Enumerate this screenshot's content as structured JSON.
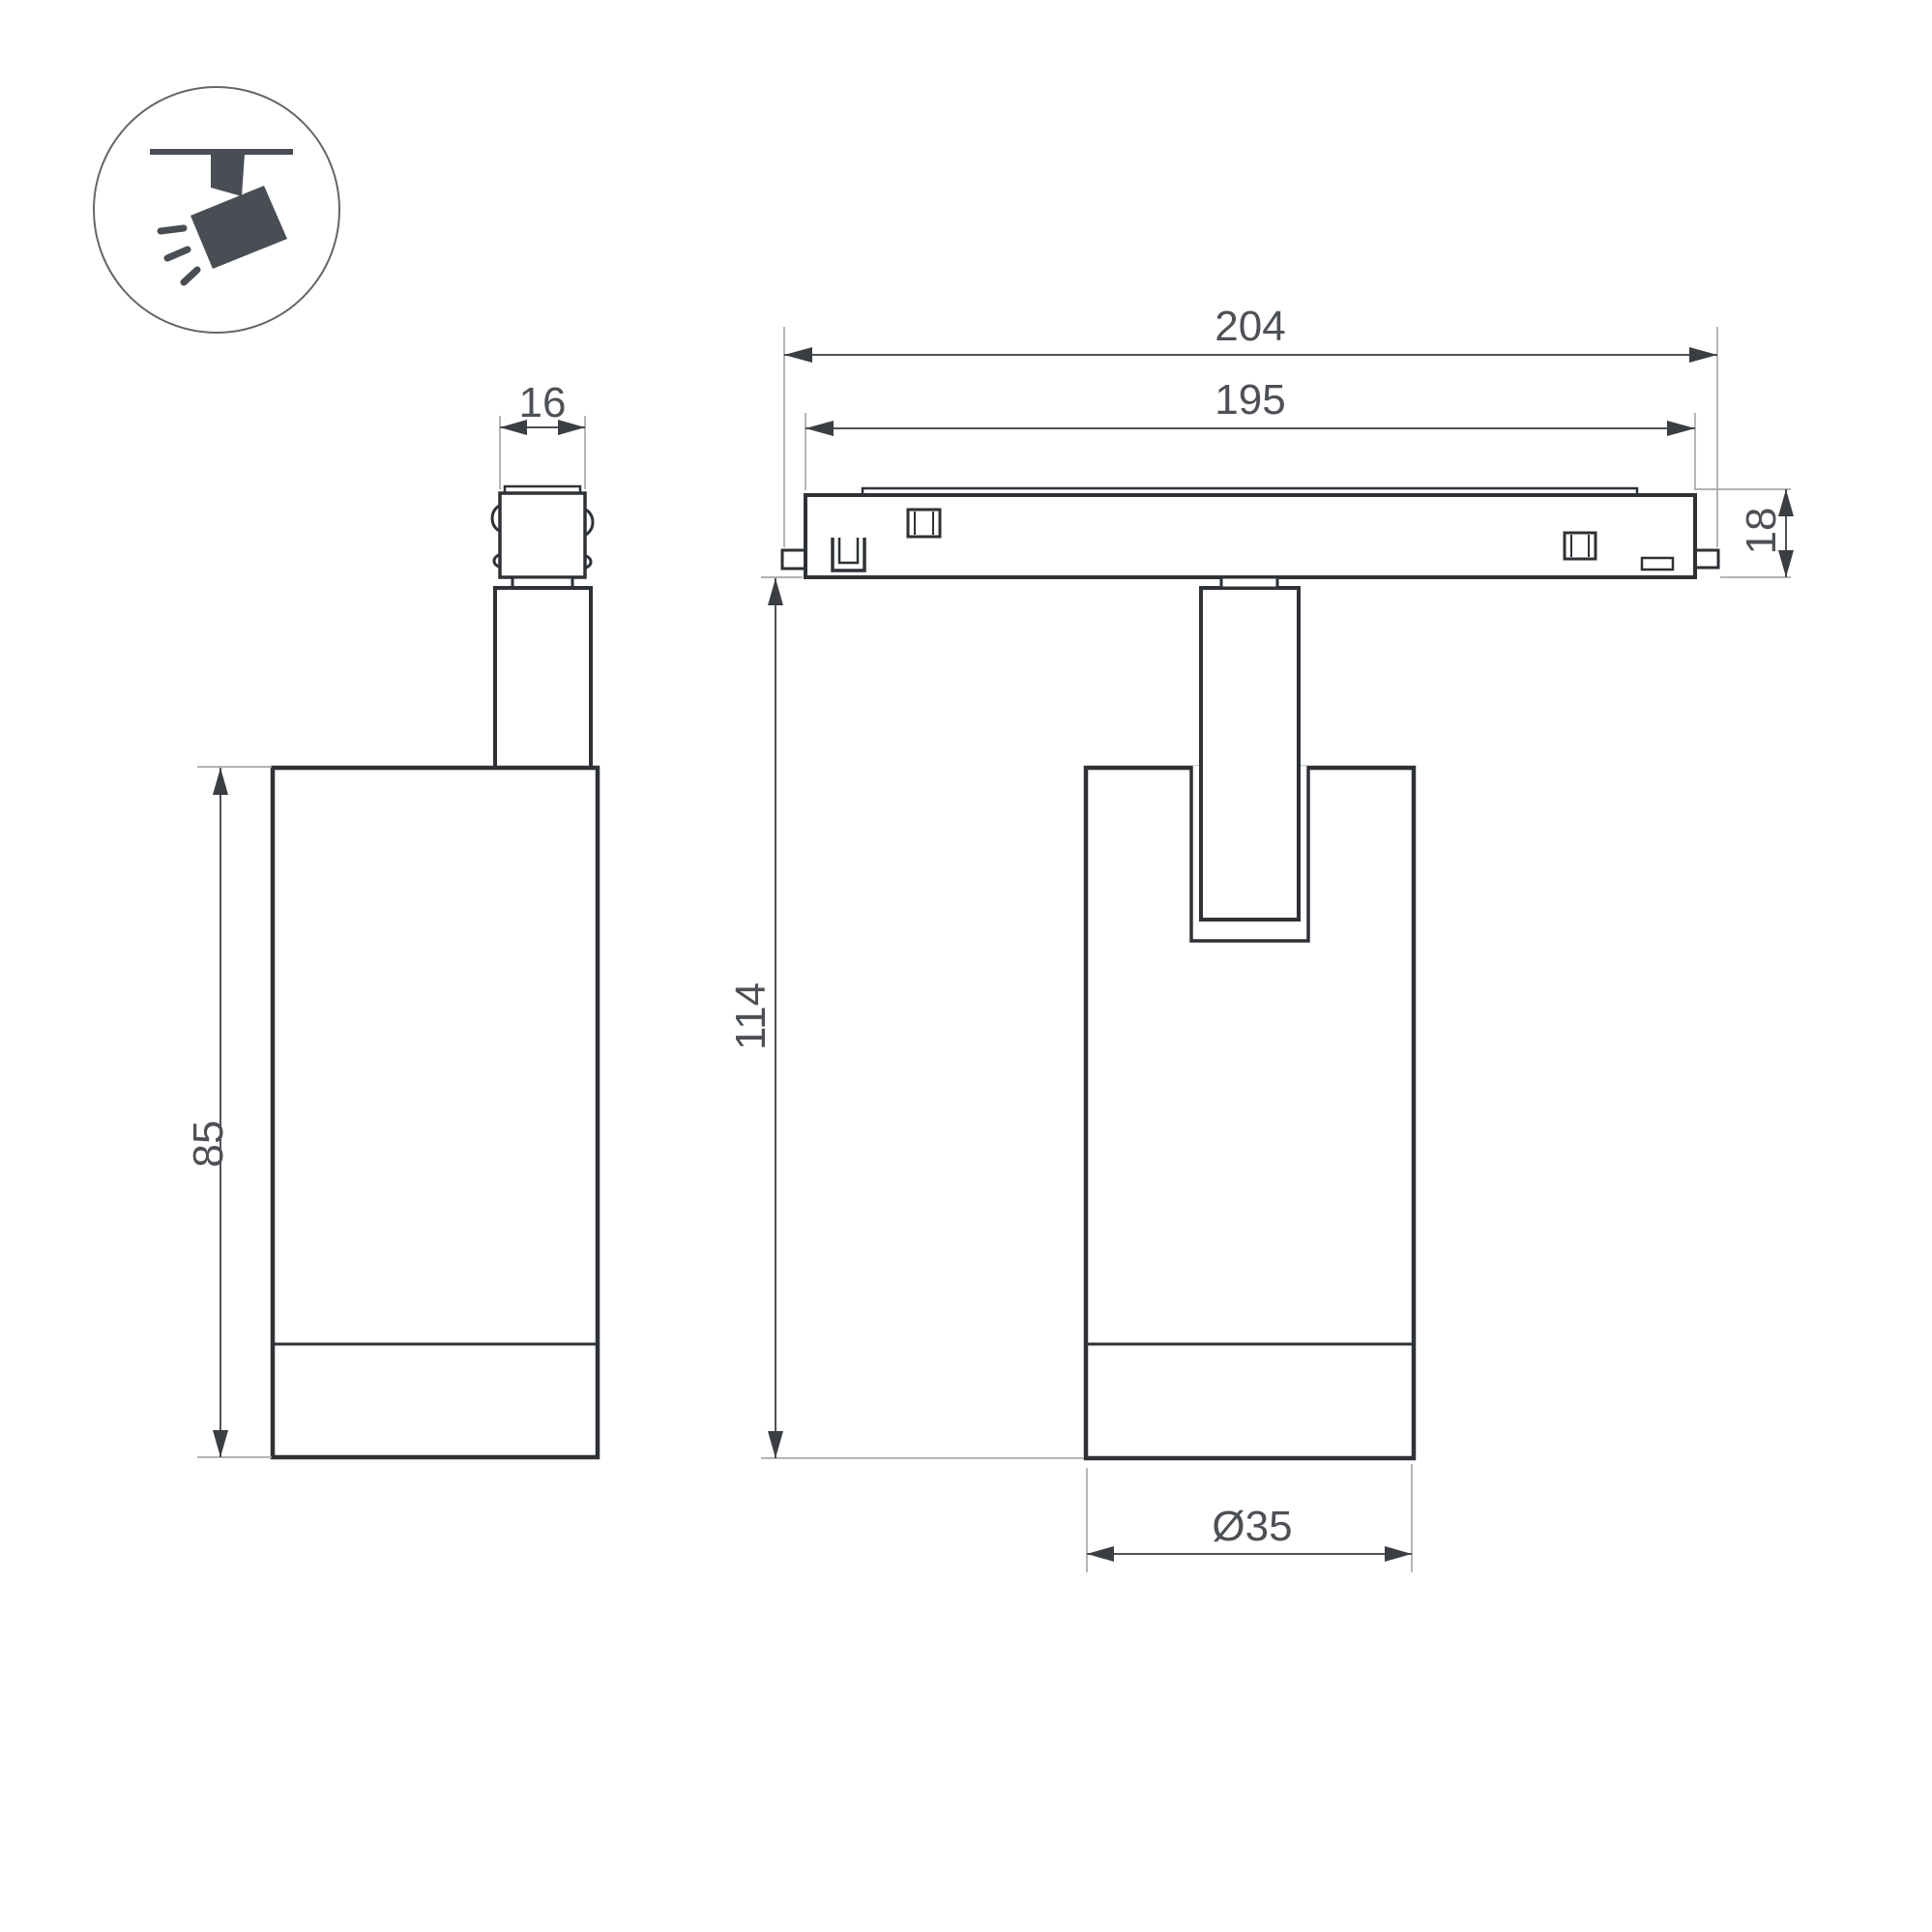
{
  "drawing": {
    "title": "Track spotlight dimension drawing",
    "dimensions": {
      "adapter_width": "16",
      "track_length_total": "204",
      "track_length_body": "195",
      "track_height": "18",
      "housing_height": "85",
      "total_height": "114",
      "diameter": "Ø35"
    },
    "colors": {
      "background": "#ffffff",
      "outline": "#2e3236",
      "dimension_line": "#4f5357",
      "extension_line": "#a8a8a8",
      "arrow": "#3a3e42",
      "text": "#4d5156",
      "icon_fill": "#484e54",
      "icon_circle": "#62666a"
    }
  }
}
